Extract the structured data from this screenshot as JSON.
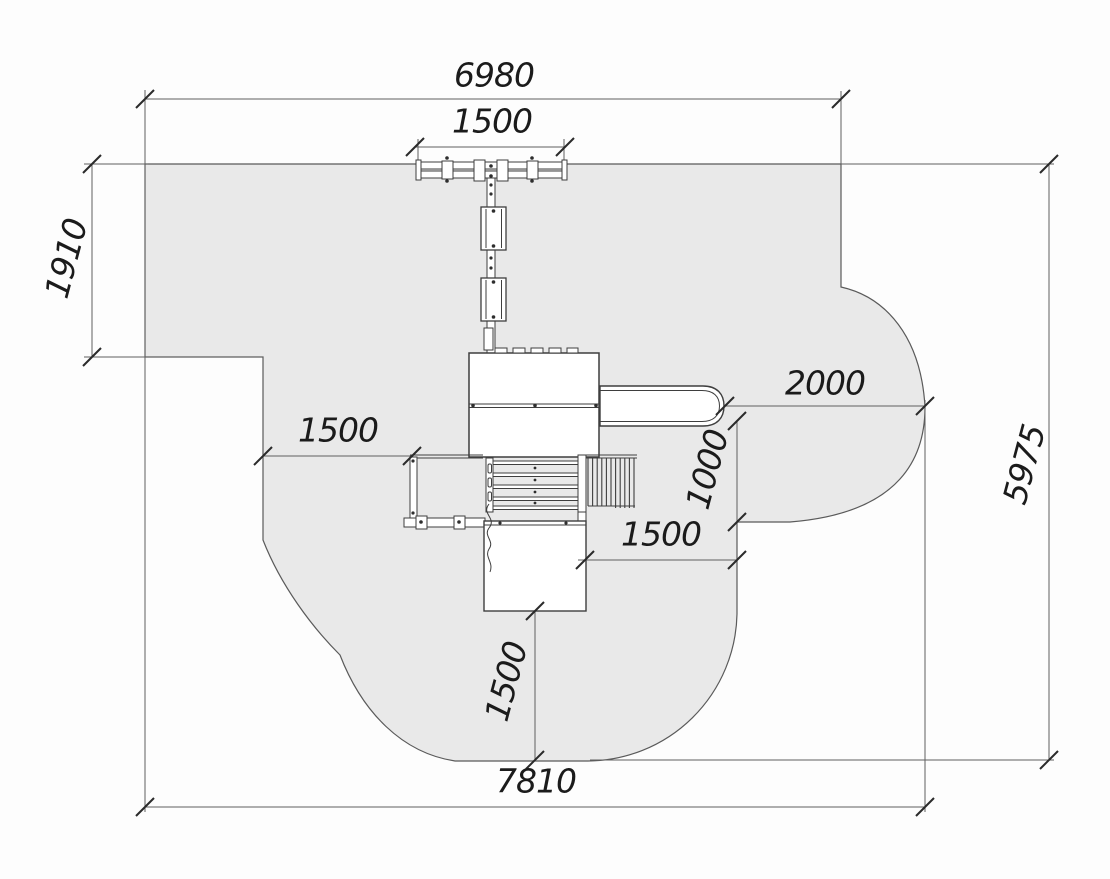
{
  "dimensions": {
    "overall_width_top": "6980",
    "swing_beam_width": "1500",
    "left_notch_height": "1910",
    "slide_safety_clearance": "2000",
    "overall_height_right": "5975",
    "left_side_clearance": "1500",
    "slide_side_clearance": "1000",
    "right_mid_clearance": "1500",
    "bottom_clearance": "1500",
    "overall_width_bottom": "7810"
  },
  "colors": {
    "zone_fill": "#e9e9e9",
    "background": "#fdfdfd",
    "equipment_line": "#3e3e3e",
    "dimension_line": "#606060",
    "label_text": "#1b1b1b"
  }
}
